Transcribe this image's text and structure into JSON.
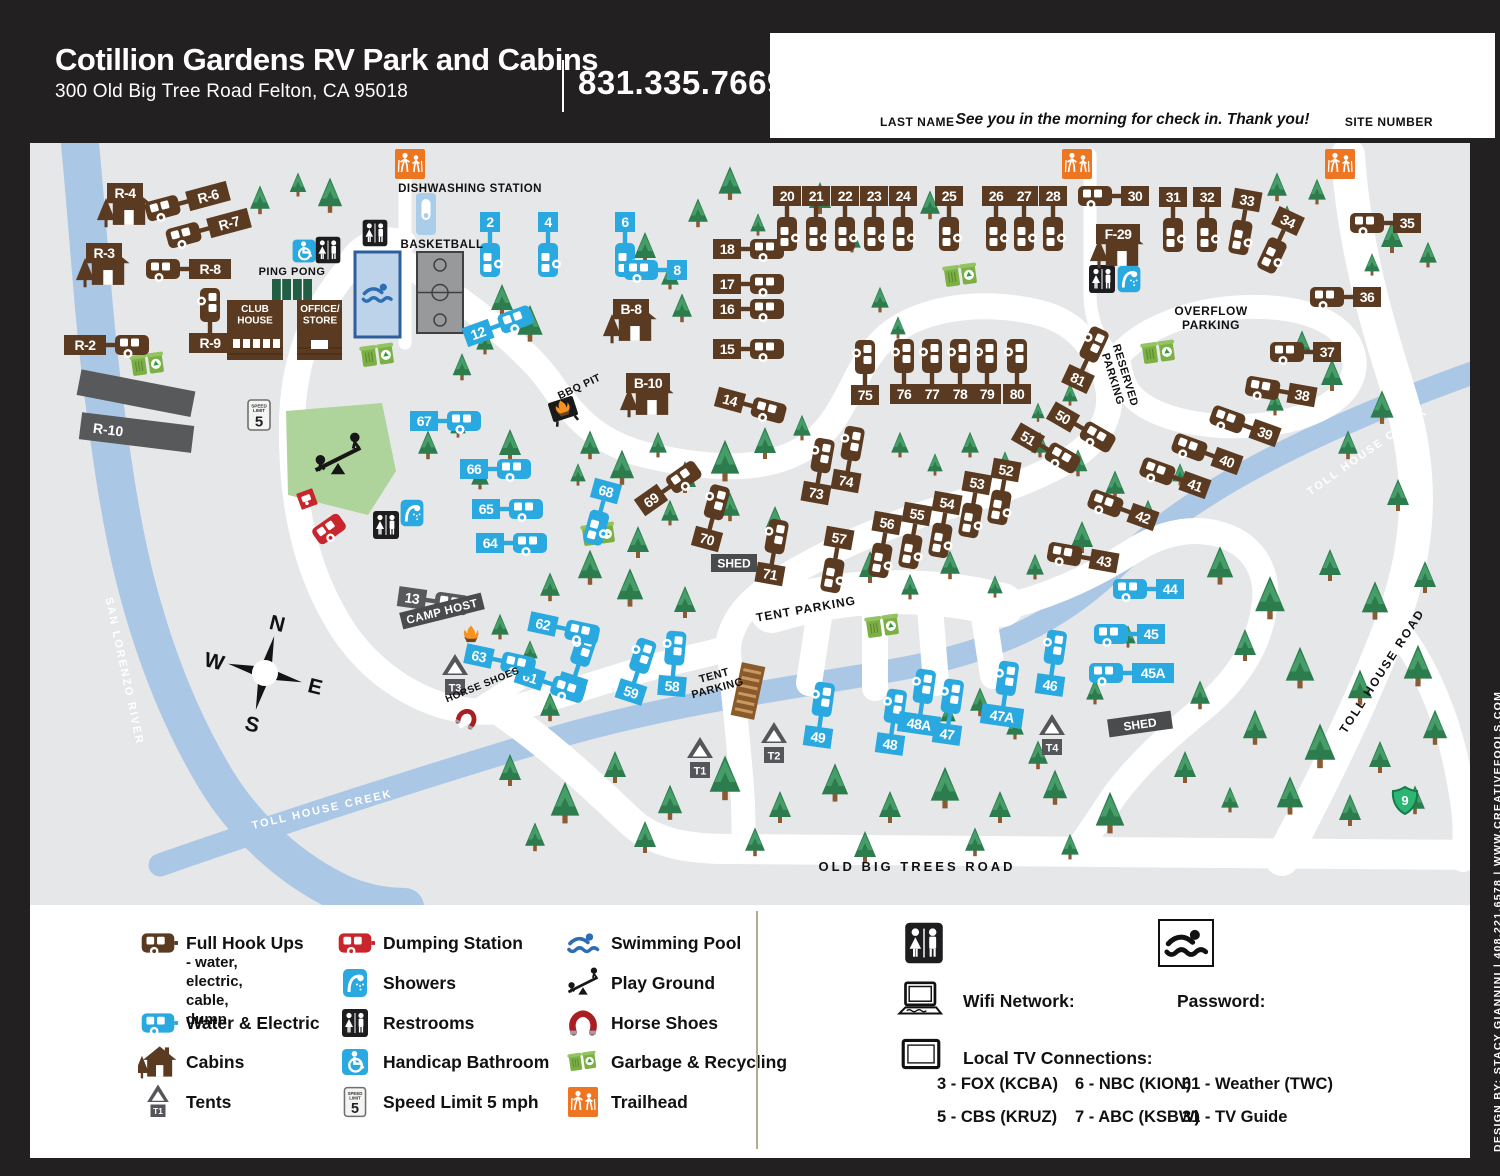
{
  "header": {
    "title": "Cotillion Gardens RV Park and Cabins",
    "address": "300 Old Big Tree Road Felton, CA 95018",
    "phone": "831.335.7669"
  },
  "checkin": {
    "last_name_label": "LAST NAME",
    "message": "See you in the morning for check in. Thank you!",
    "site_number_label": "SITE NUMBER"
  },
  "credit": "DESIGN BY: STACY GIANNINI  |  408.221.6578  |  WWW.CREATIVEFOOLS.COM",
  "colors": {
    "black": "#232021",
    "map_bg": "#e6e7e8",
    "blue": "#29a9e0",
    "brown": "#5a3a20",
    "red": "#c9252c",
    "gray": "#58595b",
    "water": "#abc7e6",
    "tree": "#2c7c4e",
    "tree_light": "#469d68",
    "trunk": "#8a5a33",
    "playground": "#aed49c",
    "orange": "#ed7623",
    "shield_green": "#2bb673",
    "pool_fill": "#bdd3ea",
    "pool_border": "#2d5f9e",
    "court": "#98999b",
    "garbage_green": "#7db044"
  },
  "map": {
    "sites": [
      [
        "2",
        "we",
        460,
        79,
        0,
        "b"
      ],
      [
        "4",
        "we",
        518,
        79,
        0,
        "b"
      ],
      [
        "6",
        "we",
        595,
        79,
        0,
        "b"
      ],
      [
        "8",
        "we",
        647,
        127,
        0,
        "l"
      ],
      [
        "12",
        "we",
        448,
        190,
        -20,
        "r"
      ],
      [
        "13",
        "host",
        382,
        455,
        8,
        "r"
      ],
      [
        "14",
        "fh",
        700,
        257,
        15,
        "r"
      ],
      [
        "15",
        "fh",
        697,
        206,
        0,
        "r"
      ],
      [
        "16",
        "fh",
        697,
        166,
        0,
        "r"
      ],
      [
        "17",
        "fh",
        697,
        141,
        0,
        "r"
      ],
      [
        "18",
        "fh",
        697,
        106,
        0,
        "r"
      ],
      [
        "20",
        "fh",
        757,
        53,
        0,
        "b"
      ],
      [
        "21",
        "fh",
        786,
        53,
        0,
        "b"
      ],
      [
        "22",
        "fh",
        815,
        53,
        0,
        "b"
      ],
      [
        "23",
        "fh",
        844,
        53,
        0,
        "b"
      ],
      [
        "24",
        "fh",
        873,
        53,
        0,
        "b"
      ],
      [
        "25",
        "fh",
        919,
        53,
        0,
        "b"
      ],
      [
        "26",
        "fh",
        966,
        53,
        0,
        "b"
      ],
      [
        "27",
        "fh",
        994,
        53,
        0,
        "b"
      ],
      [
        "28",
        "fh",
        1023,
        53,
        0,
        "b"
      ],
      [
        "30",
        "fh",
        1105,
        53,
        0,
        "l"
      ],
      [
        "31",
        "fh",
        1143,
        54,
        0,
        "b"
      ],
      [
        "32",
        "fh",
        1177,
        54,
        0,
        "b"
      ],
      [
        "33",
        "fh",
        1217,
        57,
        10,
        "b"
      ],
      [
        "34",
        "fh",
        1258,
        78,
        25,
        "b"
      ],
      [
        "35",
        "fh",
        1377,
        80,
        0,
        "l"
      ],
      [
        "36",
        "fh",
        1337,
        154,
        0,
        "l"
      ],
      [
        "37",
        "fh",
        1297,
        209,
        0,
        "l"
      ],
      [
        "38",
        "fh",
        1272,
        252,
        10,
        "l"
      ],
      [
        "39",
        "fh",
        1235,
        290,
        20,
        "l"
      ],
      [
        "40",
        "fh",
        1197,
        318,
        20,
        "l"
      ],
      [
        "41",
        "fh",
        1165,
        342,
        20,
        "l"
      ],
      [
        "42",
        "fh",
        1113,
        374,
        20,
        "l"
      ],
      [
        "43",
        "fh",
        1074,
        418,
        10,
        "l"
      ],
      [
        "44",
        "we",
        1140,
        446,
        0,
        "l"
      ],
      [
        "45",
        "we",
        1121,
        491,
        0,
        "l"
      ],
      [
        "45A",
        "we",
        1123,
        530,
        0,
        "l"
      ],
      [
        "46",
        "we",
        1020,
        542,
        8,
        "t"
      ],
      [
        "47",
        "we",
        917,
        591,
        8,
        "t"
      ],
      [
        "47A",
        "we",
        972,
        573,
        8,
        "t"
      ],
      [
        "48",
        "we",
        860,
        601,
        8,
        "t"
      ],
      [
        "48A",
        "we",
        889,
        581,
        8,
        "t"
      ],
      [
        "49",
        "we",
        788,
        594,
        8,
        "t"
      ],
      [
        "50",
        "fh",
        1033,
        274,
        30,
        "r"
      ],
      [
        "51",
        "fh",
        998,
        295,
        30,
        "r"
      ],
      [
        "52",
        "fh",
        976,
        327,
        10,
        "b"
      ],
      [
        "53",
        "fh",
        947,
        340,
        10,
        "b"
      ],
      [
        "54",
        "fh",
        917,
        360,
        10,
        "b"
      ],
      [
        "55",
        "fh",
        887,
        371,
        10,
        "b"
      ],
      [
        "56",
        "fh",
        857,
        380,
        10,
        "b"
      ],
      [
        "57",
        "fh",
        809,
        395,
        10,
        "b"
      ],
      [
        "58",
        "we",
        642,
        543,
        5,
        "t"
      ],
      [
        "59",
        "we",
        601,
        549,
        18,
        "t"
      ],
      [
        "60",
        "we",
        542,
        542,
        18,
        "t"
      ],
      [
        "61",
        "we",
        500,
        534,
        18,
        "r"
      ],
      [
        "62",
        "we",
        513,
        481,
        12,
        "r"
      ],
      [
        "63",
        "we",
        449,
        513,
        12,
        "r"
      ],
      [
        "64",
        "we",
        460,
        400,
        0,
        "r"
      ],
      [
        "65",
        "we",
        456,
        366,
        0,
        "r"
      ],
      [
        "66",
        "we",
        444,
        326,
        0,
        "r"
      ],
      [
        "67",
        "we",
        394,
        278,
        0,
        "r"
      ],
      [
        "68",
        "we",
        576,
        348,
        15,
        "b"
      ],
      [
        "69",
        "fh",
        621,
        357,
        -35,
        "r"
      ],
      [
        "70",
        "fh",
        677,
        396,
        15,
        "t"
      ],
      [
        "71",
        "fh",
        740,
        431,
        10,
        "t"
      ],
      [
        "73",
        "fh",
        786,
        350,
        10,
        "t"
      ],
      [
        "74",
        "fh",
        816,
        338,
        10,
        "t"
      ],
      [
        "75",
        "fh",
        835,
        252,
        0,
        "t"
      ],
      [
        "76",
        "fh",
        874,
        251,
        0,
        "t"
      ],
      [
        "77",
        "fh",
        902,
        251,
        0,
        "t"
      ],
      [
        "78",
        "fh",
        930,
        251,
        0,
        "t"
      ],
      [
        "79",
        "fh",
        957,
        251,
        0,
        "t"
      ],
      [
        "80",
        "fh",
        987,
        251,
        0,
        "t"
      ],
      [
        "81",
        "fh",
        1048,
        236,
        25,
        "t"
      ],
      [
        "R-2",
        "fh",
        55,
        202,
        0,
        "r"
      ],
      [
        "R-6",
        "fh",
        178,
        53,
        -15,
        "l"
      ],
      [
        "R-7",
        "fh",
        199,
        80,
        -15,
        "l"
      ],
      [
        "R-8",
        "fh",
        180,
        126,
        0,
        "l"
      ],
      [
        "R-9",
        "fh",
        180,
        200,
        0,
        "t"
      ]
    ],
    "cabins": [
      [
        "R-4",
        95,
        50
      ],
      [
        "R-3",
        74,
        110
      ],
      [
        "B-8",
        601,
        166
      ],
      [
        "B-10",
        618,
        240
      ],
      [
        "F-29",
        1088,
        91
      ]
    ],
    "tents": [
      [
        "T1",
        670,
        606
      ],
      [
        "T2",
        744,
        591
      ],
      [
        "T3",
        425,
        523
      ],
      [
        "T4",
        1022,
        583
      ]
    ],
    "sheds": [
      {
        "t": "SHED",
        "x": 704,
        "y": 420,
        "r": 0,
        "w": 46
      },
      {
        "t": "SHED",
        "x": 1110,
        "y": 581,
        "r": -8,
        "w": 64
      }
    ],
    "camp_host": {
      "t": "CAMP HOST",
      "x": 412,
      "y": 468,
      "r": -14
    },
    "r10_label": "R-10",
    "buildings": {
      "club": "CLUB|HOUSE",
      "office": "OFFICE/|STORE"
    },
    "speed_sign": {
      "l1": "SPEED",
      "l2": "LIMIT",
      "v": "5"
    },
    "compass": {
      "n": "N",
      "e": "E",
      "s": "S",
      "w": "W"
    },
    "shield": "9",
    "area_labels": [
      {
        "t": "DISHWASHING STATION",
        "x": 440,
        "y": 45,
        "s": 11.5
      },
      {
        "t": "BASKETBALL",
        "x": 412,
        "y": 101,
        "s": 11.5
      },
      {
        "t": "PING PONG",
        "x": 262,
        "y": 128,
        "s": 11
      },
      {
        "t": "OVERFLOW|PARKING",
        "x": 1181,
        "y": 168,
        "s": 12
      },
      {
        "t": "RESERVED|PARKING",
        "x": 1096,
        "y": 232,
        "s": 11,
        "r": 73
      },
      {
        "t": "TENT PARKING",
        "x": 776,
        "y": 466,
        "s": 12,
        "r": -10,
        "sp": 1
      },
      {
        "t": "TENT|PARKING",
        "x": 684,
        "y": 532,
        "s": 11,
        "r": -15
      },
      {
        "t": "HORSE SHOES",
        "x": 452,
        "y": 541,
        "s": 10,
        "r": -22
      },
      {
        "t": "BBQ PIT",
        "x": 549,
        "y": 243,
        "s": 10.5,
        "r": -25
      }
    ],
    "road_labels": [
      {
        "t": "OLD BIG TREES ROAD",
        "x": 887,
        "y": 724,
        "s": 13,
        "sp": 3,
        "c": "#111"
      },
      {
        "t": "TOLL HOUSE ROAD",
        "x": 1352,
        "y": 528,
        "s": 12,
        "r": -57,
        "sp": 2,
        "c": "#111"
      },
      {
        "t": "TOLL HOUSE CREEK",
        "x": 292,
        "y": 666,
        "s": 11,
        "sp": 2,
        "c": "#fff",
        "r": -13
      },
      {
        "t": "TOLL HOUSE CREEK",
        "x": 1337,
        "y": 308,
        "s": 11,
        "sp": 2,
        "c": "#fff",
        "r": -35
      },
      {
        "t": "SAN LORENZO RIVER",
        "x": 95,
        "y": 528,
        "s": 11,
        "sp": 2,
        "c": "#fff",
        "r": 78
      }
    ]
  },
  "legend": {
    "tent_chip": "T1",
    "columns": [
      {
        "x": 108,
        "rows": [
          38,
          118,
          157,
          197
        ],
        "items": [
          {
            "icon": "trailer-brown",
            "label": "Full Hook Ups",
            "sub": "- water, electric,\n  cable, dump"
          },
          {
            "icon": "trailer-blue",
            "label": "Water & Electric"
          },
          {
            "icon": "cabin",
            "label": "Cabins"
          },
          {
            "icon": "tent",
            "label": "Tents"
          }
        ]
      },
      {
        "x": 305,
        "rows": [
          38,
          78,
          118,
          157,
          197
        ],
        "items": [
          {
            "icon": "trailer-red",
            "label": "Dumping Station"
          },
          {
            "icon": "shower",
            "label": "Showers"
          },
          {
            "icon": "restroom",
            "label": "Restrooms"
          },
          {
            "icon": "handicap",
            "label": "Handicap Bathroom"
          },
          {
            "icon": "speed",
            "label": "Speed Limit 5 mph"
          }
        ]
      },
      {
        "x": 533,
        "rows": [
          38,
          78,
          118,
          157,
          197
        ],
        "items": [
          {
            "icon": "swim",
            "label": "Swimming Pool"
          },
          {
            "icon": "seesaw",
            "label": "Play Ground"
          },
          {
            "icon": "horseshoe",
            "label": "Horse Shoes"
          },
          {
            "icon": "garbage",
            "label": "Garbage & Recycling"
          },
          {
            "icon": "trailhead",
            "label": "Trailhead"
          }
        ]
      }
    ]
  },
  "info": {
    "wifi_label": "Wifi Network:",
    "password_label": "Password:",
    "tv_title": "Local TV Connections:",
    "tv_rows": [
      [
        "3 - FOX (KCBA)",
        "6 - NBC (KION)",
        "61 - Weather (TWC)"
      ],
      [
        "5 - CBS (KRUZ)",
        "7 - ABC (KSBW)",
        "31 - TV Guide"
      ]
    ]
  }
}
